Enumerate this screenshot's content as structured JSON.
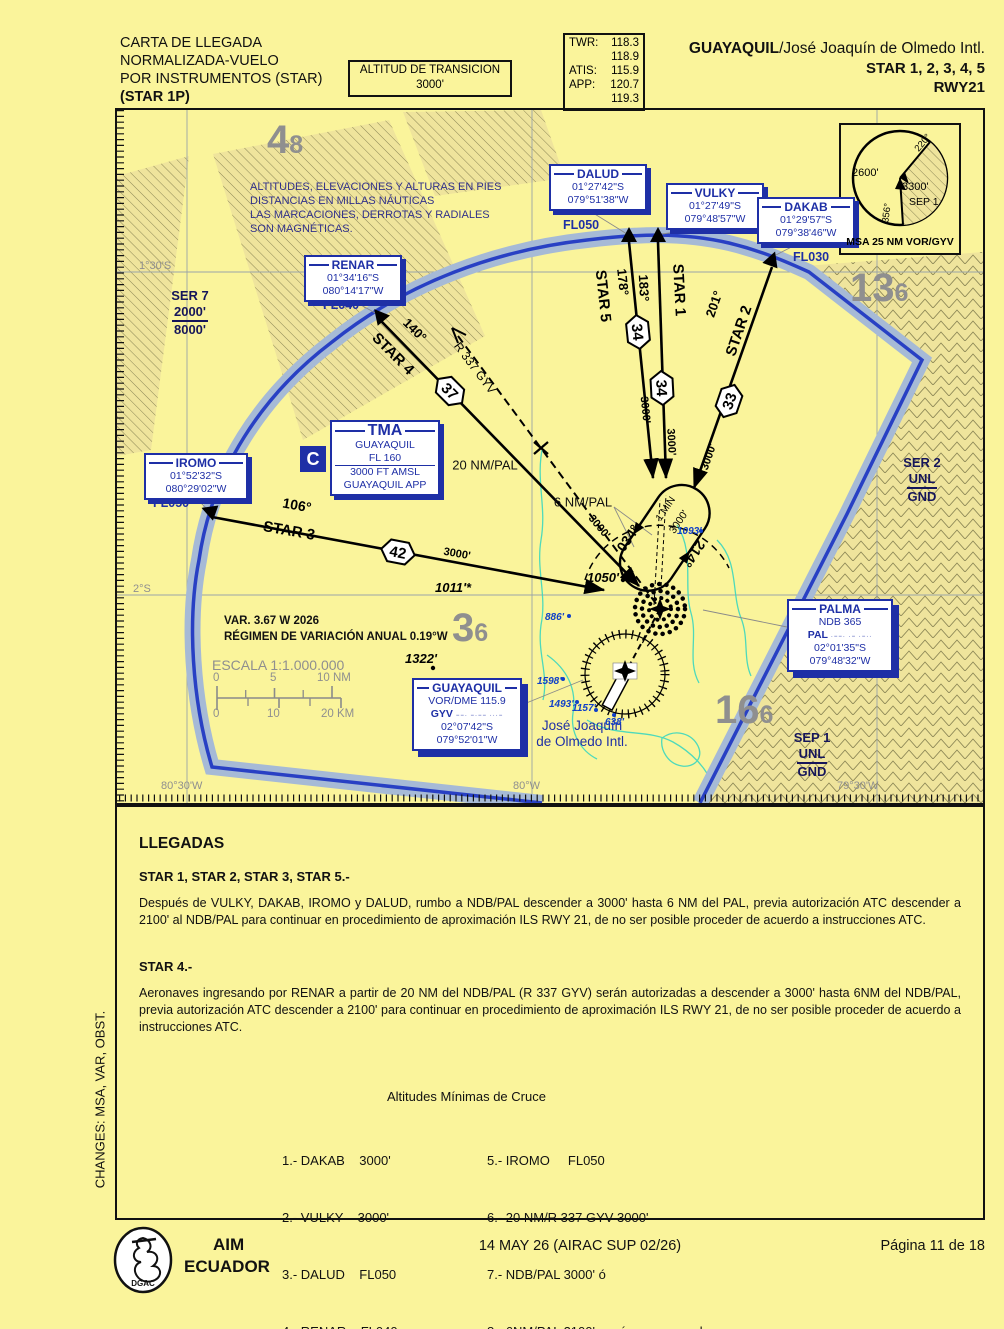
{
  "header": {
    "title_line1": "CARTA DE LLEGADA",
    "title_line2": "NORMALIZADA-VUELO",
    "title_line3": "POR INSTRUMENTOS (STAR)",
    "title_line4": "(STAR 1P)",
    "transition_line1": "ALTITUD DE TRANSICION",
    "transition_line2": "3000'",
    "freqs": {
      "twr_label": "TWR:",
      "twr1": "118.3",
      "twr2": "118.9",
      "atis_label": "ATIS:",
      "atis": "115.9",
      "app_label": "APP:",
      "app1": "120.7",
      "app2": "119.3"
    },
    "airport_bold": "GUAYAQUIL",
    "airport_rest": "/José Joaquín de Olmedo Intl.",
    "stars_line": "STAR 1, 2, 3, 4, 5",
    "rwy_line": "RWY21"
  },
  "map": {
    "note": [
      "ALTITUDES, ELEVACIONES Y ALTURAS EN PIES",
      "DISTANCIAS EN MILLAS NÁUTICAS",
      "LAS MARCACIONES, DERROTAS Y RADIALES",
      "SON MAGNÉTICAS."
    ],
    "mora": {
      "nw": {
        "big": "4",
        "sub": "8"
      },
      "ne": {
        "big": "13",
        "sub": "6"
      },
      "sw": {
        "big": "3",
        "sub": "6"
      },
      "se": {
        "big": "16",
        "sub": "6"
      }
    },
    "areas": {
      "ser7": {
        "name": "SER 7",
        "upper": "2000'",
        "lower": "8000'"
      },
      "ser2": {
        "name": "SER 2",
        "upper": "UNL",
        "lower": "GND"
      },
      "sep1": {
        "name": "SEP 1",
        "upper": "UNL",
        "lower": "GND"
      }
    },
    "grid": {
      "lat1": "1°30'S",
      "lat2": "2°S",
      "lon1": "80°30'W",
      "lon2": "80°W",
      "lon3": "79°30'W"
    },
    "msa": {
      "alt_w": "2600'",
      "alt_e": "3300'",
      "sector": "SEP 1",
      "brg1": "220°",
      "brg2": "356°",
      "caption": "MSA 25 NM VOR/GYV"
    },
    "waypoints": {
      "dalud": {
        "name": "DALUD",
        "lat": "01°27'42\"S",
        "lon": "079°51'38\"W",
        "fl": "FL050"
      },
      "vulky": {
        "name": "VULKY",
        "lat": "01°27'49\"S",
        "lon": "079°48'57\"W",
        "fl": "FL030"
      },
      "dakab": {
        "name": "DAKAB",
        "lat": "01°29'57\"S",
        "lon": "079°38'46\"W",
        "fl": "FL030"
      },
      "renar": {
        "name": "RENAR",
        "lat": "01°34'16\"S",
        "lon": "080°14'17\"W",
        "fl": "FL040"
      },
      "iromo": {
        "name": "IROMO",
        "lat": "01°52'32\"S",
        "lon": "080°29'02\"W",
        "fl": "FL050"
      }
    },
    "navaids": {
      "palma": {
        "name": "PALMA",
        "line1": "NDB 365",
        "ident": "PAL",
        "morse": "·−−· ·− ·−··",
        "lat": "02°01'35\"S",
        "lon": "079°48'32\"W"
      },
      "gyv": {
        "name": "GUAYAQUIL",
        "line1": "VOR/DME 115.9",
        "ident": "GYV",
        "morse": "−−· −·−− ···−",
        "lat": "02°07'42\"S",
        "lon": "079°52'01\"W"
      }
    },
    "tma": {
      "title": "TMA",
      "line1": "GUAYAQUIL",
      "line2": "FL 160",
      "line3": "3000 FT AMSL",
      "line4": "GUAYAQUIL APP",
      "class": "C"
    },
    "stars": {
      "star1": {
        "name": "STAR 1",
        "course": "183°",
        "dist": "34",
        "alt": "3000'"
      },
      "star2": {
        "name": "STAR 2",
        "course": "201°",
        "dist": "33",
        "alt": "3000'"
      },
      "star3": {
        "name": "STAR 3",
        "course": "106°",
        "dist": "42",
        "alt": "3000'"
      },
      "star4": {
        "name": "STAR 4",
        "course": "140°",
        "dist": "37",
        "alt": "3000'"
      },
      "star5": {
        "name": "STAR 5",
        "course": "178°",
        "dist": "34",
        "alt": "3000'"
      }
    },
    "labels": {
      "r337": "R 337 GYV",
      "twenty_nm": "20 NM/PAL",
      "six_nm": "6 NM/PAL",
      "hold_in": "034°",
      "hold_out": "214°",
      "hold_time": "1 MIN",
      "hold_alt": "3000'"
    },
    "spots": {
      "s1011": "1011'*",
      "s1050": "1050'",
      "s1322": "1322'",
      "s886": "886'",
      "s1093": "1093'",
      "s1598": "1598'",
      "s1493": "1493'",
      "s1157": "1157'",
      "s638": "638'"
    },
    "var_line1": "VAR. 3.67 W 2026",
    "var_line2": "RÉGIMEN DE VARIACIÓN ANUAL 0.19°W",
    "scale": {
      "title": "ESCALA 1:1.000.000",
      "nm0": "0",
      "nm5": "5",
      "nm10": "10 NM",
      "km0": "0",
      "km10": "10",
      "km20": "20 KM"
    },
    "airport_name1": "José Joaquín",
    "airport_name2": "de Olmedo Intl."
  },
  "text_section": {
    "heading": "LLEGADAS",
    "sub1": "STAR 1, STAR 2, STAR 3, STAR 5.-",
    "para1": "Después de VULKY, DAKAB, IROMO y DALUD, rumbo a NDB/PAL descender a 3000' hasta 6 NM del PAL, previa autorización ATC descender a 2100' al NDB/PAL para continuar en procedimiento de aproximación ILS RWY 21, de no ser posible proceder de acuerdo a instrucciones ATC.",
    "sub2": "STAR 4.-",
    "para2": "Aeronaves ingresando por RENAR a partir de 20 NM del NDB/PAL (R 337 GYV) serán autorizadas a descender a 3000' hasta 6NM del NDB/PAL, previa autorización ATC descender a 2100' para continuar en procedimiento de aproximación ILS RWY 21, de no ser posible proceder de acuerdo a instrucciones ATC.",
    "min_alt_title": "Altitudes Mínimas de Cruce",
    "min_alts_col1": [
      "1.- DAKAB    3000'",
      "2.- VULKY    3000'",
      "3.- DALUD    FL050",
      "4.- RENAR    FL040"
    ],
    "min_alts_col2": [
      "5.- IROMO     FL050",
      "6.- 20 NM/R 337 GYV 3000'",
      "7.- NDB/PAL 3000' ó",
      "8.- 6NM/PAL 2100' según corresponda"
    ],
    "changes": "CHANGES: MSA, VAR, OBST."
  },
  "footer": {
    "org1": "AIM",
    "org2": "ECUADOR",
    "logo": "DGAC",
    "date": "14 MAY 26 (AIRAC SUP 02/26)",
    "page": "Página 11 de 18"
  }
}
